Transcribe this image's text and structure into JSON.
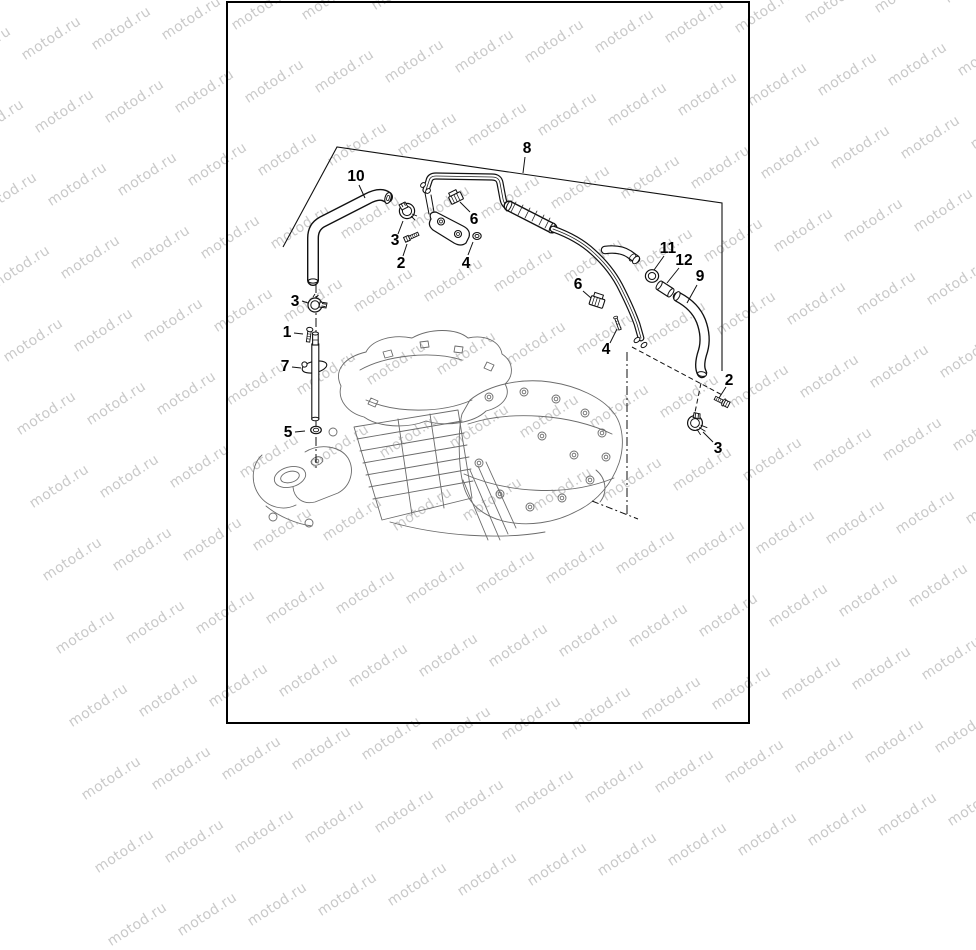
{
  "watermark": {
    "text": "motod.ru",
    "color": "#c9c9c9"
  },
  "diagram": {
    "background_color": "#ffffff",
    "border_color": "#000000",
    "line_color": "#111111",
    "engine_line_color": "#6b6b6b",
    "callouts": [
      {
        "label": "8"
      },
      {
        "label": "10"
      },
      {
        "label": "3"
      },
      {
        "label": "2"
      },
      {
        "label": "4"
      },
      {
        "label": "6"
      },
      {
        "label": "11"
      },
      {
        "label": "12"
      },
      {
        "label": "9"
      },
      {
        "label": "6"
      },
      {
        "label": "4"
      },
      {
        "label": "2"
      },
      {
        "label": "3"
      },
      {
        "label": "3"
      },
      {
        "label": "1"
      },
      {
        "label": "7"
      },
      {
        "label": "5"
      }
    ]
  }
}
